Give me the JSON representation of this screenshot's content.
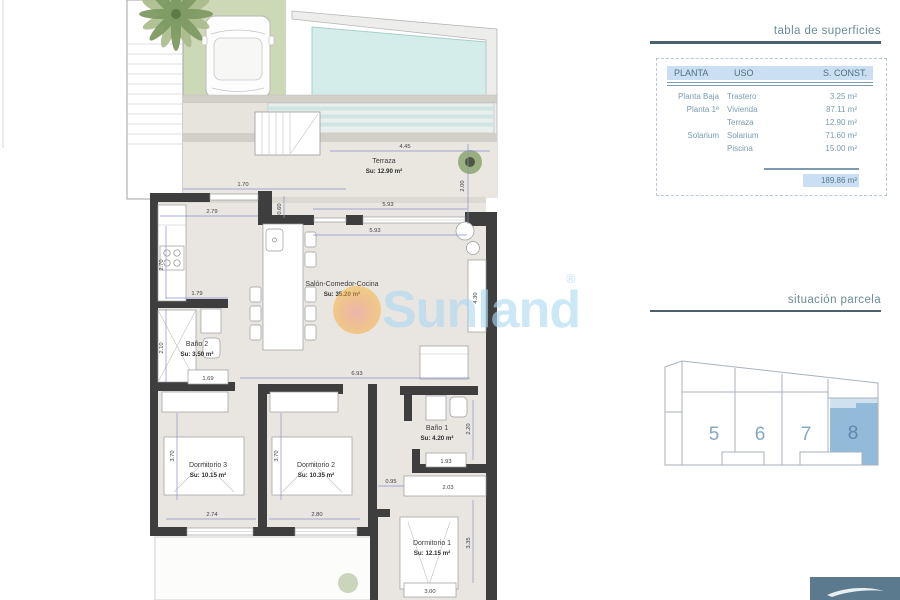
{
  "plan": {
    "watermark": "Sunland",
    "watermark_reg": "®",
    "rooms": {
      "terraza": {
        "name": "Terraza",
        "area": "Su: 12.90 m²"
      },
      "salon": {
        "name": "Salón-Comedor-Cocina",
        "area": "Su: 35.20 m²"
      },
      "bano2": {
        "name": "Baño 2",
        "area": "Su: 3.50 m²"
      },
      "bano1": {
        "name": "Baño 1",
        "area": "Su: 4.20 m²"
      },
      "dorm3": {
        "name": "Dormitorio 3",
        "area": "Su: 10.15 m²"
      },
      "dorm2": {
        "name": "Dormitorio 2",
        "area": "Su: 10.35 m²"
      },
      "dorm1": {
        "name": "Dormitorio 1",
        "area": "Su: 12.15 m²"
      }
    },
    "dims": {
      "d445": "4.45",
      "d200": "2.00",
      "d170": "1.70",
      "d060": "0.60",
      "d593a": "5.93",
      "d593b": "5.93",
      "d279": "2.79",
      "d270": "2.70",
      "d179": "1.79",
      "d210": "2.10",
      "d169": "1.69",
      "d693": "6.93",
      "d370a": "3.70",
      "d274": "2.74",
      "d370b": "3.70",
      "d280": "2.80",
      "d095": "0.95",
      "d203": "2.03",
      "d193": "1.93",
      "d220": "2.20",
      "d430": "4.30",
      "d335": "3.35",
      "d300": "3.00"
    }
  },
  "surface_table": {
    "title": "tabla de superficies",
    "headers": [
      "PLANTA",
      "USO",
      "S. CONST."
    ],
    "rows": [
      {
        "planta": "Planta Baja",
        "uso": "Trastero",
        "sup": "3.25 m²"
      },
      {
        "planta": "Planta 1ª",
        "uso": "Vivienda",
        "sup": "87.11 m²"
      },
      {
        "planta": "",
        "uso": "Terraza",
        "sup": "12.90 m²"
      },
      {
        "planta": "Solarium",
        "uso": "Solarium",
        "sup": "71.60 m²"
      },
      {
        "planta": "",
        "uso": "Piscina",
        "sup": "15.00 m²"
      }
    ],
    "total": "189.86 m²"
  },
  "site": {
    "title": "situación parcela",
    "plots": [
      "5",
      "6",
      "7",
      "8"
    ],
    "highlighted_plot": "8"
  },
  "colors": {
    "wall": "#3e3e3e",
    "pool": "#d5edea",
    "grass": "#cdd8b6",
    "floor": "#e9e6e1",
    "dimension_line": "#8a8fd0",
    "watermark_blue": "#aed9f2",
    "watermark_sun": "#f5a93c",
    "plot_highlight": "#92bbda",
    "plot_highlight_light": "#cfe0ef",
    "table_header_bg": "#cadff1",
    "panel_title": "#6b8c98",
    "logo_box": "#5b7a8e"
  }
}
